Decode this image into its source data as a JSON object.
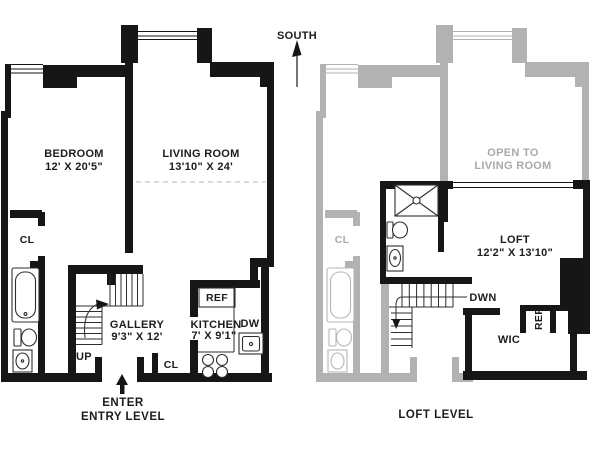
{
  "compass": {
    "label": "SOUTH"
  },
  "entry_level": {
    "caption_line1": "ENTER",
    "caption_line2": "ENTRY LEVEL",
    "bedroom_name": "BEDROOM",
    "bedroom_dims": "12' X 20'5\"",
    "living_room_name": "LIVING ROOM",
    "living_room_dims": "13'10\" X 24'",
    "gallery_name": "GALLERY",
    "gallery_dims": "9'3\" X 12'",
    "kitchen_name": "KITCHEN",
    "kitchen_dims": "7' X 9'1\"",
    "closet_label": "CL",
    "entry_closet_label": "CL",
    "up_label": "UP",
    "ref_label": "REF",
    "dw_label": "DW"
  },
  "loft_level": {
    "caption": "LOFT LEVEL",
    "loft_name": "LOFT",
    "loft_dims": "12'2\" X 13'10\"",
    "open_to_line1": "OPEN TO",
    "open_to_line2": "LIVING ROOM",
    "closet_label": "CL",
    "down_label": "DWN",
    "wic_label": "WIC",
    "ref_label": "REF"
  },
  "colors": {
    "wall": "#161616",
    "ghost": "#b2b2b2",
    "text": "#1c1c1c",
    "ghost_text": "#a9a9a9"
  }
}
